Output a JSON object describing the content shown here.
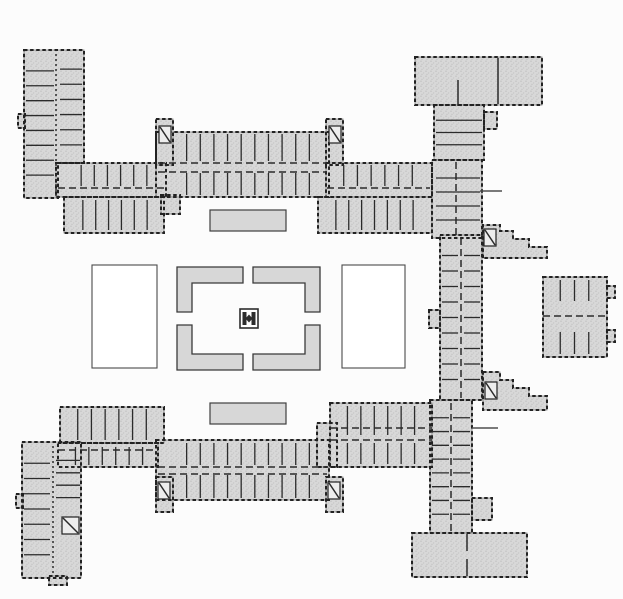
{
  "figure": {
    "type": "architectural-floor-plan",
    "description": "ground floor plan of a courtyard building complex"
  },
  "palette": {
    "background": "#fcfcfc",
    "poche_fill": "#d8d8d8",
    "stipple_dot": "#bdbdbd",
    "wall_dark": "#222222",
    "wall_medium": "#2b2b2b",
    "outline_light": "#7a7a7a",
    "courtyard_white": "#ffffff"
  },
  "plan": {
    "blocks": [
      {
        "name": "northwest-pavilion",
        "d": "M24,50 H84 V163 H58 V198 H24 Z"
      },
      {
        "name": "northwest-pavilion-west-bump",
        "x": 18,
        "y": 114,
        "w": 7,
        "h": 14
      },
      {
        "name": "northwest-link-band",
        "x": 56,
        "y": 163,
        "w": 110,
        "h": 34
      },
      {
        "name": "northwest-south-cells",
        "x": 64,
        "y": 197,
        "w": 100,
        "h": 36
      },
      {
        "name": "north-wing-south-stub",
        "x": 161,
        "y": 195,
        "w": 19,
        "h": 19
      },
      {
        "name": "north-wing-main",
        "x": 156,
        "y": 132,
        "w": 173,
        "h": 65
      },
      {
        "name": "north-wing-tower-west",
        "x": 156,
        "y": 119,
        "w": 17,
        "h": 46
      },
      {
        "name": "north-wing-tower-east",
        "x": 326,
        "y": 119,
        "w": 17,
        "h": 46
      },
      {
        "name": "north-wing-east-band",
        "x": 326,
        "y": 163,
        "w": 106,
        "h": 34
      },
      {
        "name": "north-wing-east-south-cells",
        "x": 318,
        "y": 197,
        "w": 114,
        "h": 36
      },
      {
        "name": "northeast-building",
        "x": 415,
        "y": 57,
        "w": 127,
        "h": 48
      },
      {
        "name": "northeast-link",
        "x": 434,
        "y": 105,
        "w": 50,
        "h": 55
      },
      {
        "name": "northeast-link-side-room",
        "x": 484,
        "y": 112,
        "w": 13,
        "h": 17
      },
      {
        "name": "east-wing-north",
        "x": 432,
        "y": 160,
        "w": 50,
        "h": 78
      },
      {
        "name": "east-wing-middle",
        "x": 440,
        "y": 235,
        "w": 42,
        "h": 165
      },
      {
        "name": "east-wing-west-bay",
        "x": 429,
        "y": 310,
        "w": 11,
        "h": 18
      },
      {
        "name": "east-court-north-steps",
        "d": "M483,258 V225 H500 V231 H513 V239 H529 V247 H547 V258 Z"
      },
      {
        "name": "east-court-south-steps",
        "d": "M483,372 H500 V380 H513 V388 H529 V396 H547 V410 H483 Z"
      },
      {
        "name": "east-pavilion",
        "x": 543,
        "y": 277,
        "w": 64,
        "h": 80
      },
      {
        "name": "east-pavilion-bump-north",
        "x": 607,
        "y": 286,
        "w": 8,
        "h": 12
      },
      {
        "name": "east-pavilion-bump-south",
        "x": 607,
        "y": 330,
        "w": 8,
        "h": 12
      },
      {
        "name": "east-wing-south",
        "x": 430,
        "y": 400,
        "w": 42,
        "h": 133
      },
      {
        "name": "east-wing-south-bump",
        "x": 472,
        "y": 498,
        "w": 20,
        "h": 22
      },
      {
        "name": "south-hall",
        "x": 412,
        "y": 533,
        "w": 115,
        "h": 44
      },
      {
        "name": "south-wing-main",
        "x": 156,
        "y": 440,
        "w": 173,
        "h": 60
      },
      {
        "name": "south-wing-tower-west",
        "x": 156,
        "y": 477,
        "w": 17,
        "h": 35
      },
      {
        "name": "south-wing-tower-east",
        "x": 326,
        "y": 477,
        "w": 17,
        "h": 35
      },
      {
        "name": "southwest-link-band",
        "x": 58,
        "y": 443,
        "w": 100,
        "h": 24
      },
      {
        "name": "southwest-north-cells",
        "x": 60,
        "y": 407,
        "w": 104,
        "h": 36
      },
      {
        "name": "south-wing-east-step",
        "x": 317,
        "y": 423,
        "w": 20,
        "h": 44
      },
      {
        "name": "south-wing-east-segment",
        "x": 330,
        "y": 403,
        "w": 102,
        "h": 64
      },
      {
        "name": "southwest-pavilion",
        "x": 22,
        "y": 442,
        "w": 59,
        "h": 136
      },
      {
        "name": "southwest-pavilion-west-bump",
        "x": 16,
        "y": 494,
        "w": 7,
        "h": 14
      },
      {
        "name": "southwest-pavilion-south-bump",
        "x": 49,
        "y": 576,
        "w": 18,
        "h": 9
      }
    ],
    "courtyards": [
      {
        "name": "west-parterre-court",
        "x": 92,
        "y": 265,
        "w": 65,
        "h": 103
      },
      {
        "name": "east-parterre-court",
        "x": 342,
        "y": 265,
        "w": 63,
        "h": 103
      }
    ],
    "beds": [
      {
        "name": "north-garden-bed",
        "x": 210,
        "y": 210,
        "w": 76,
        "h": 21
      },
      {
        "name": "south-garden-bed",
        "x": 210,
        "y": 403,
        "w": 76,
        "h": 21
      }
    ],
    "parterre": [
      {
        "name": "parterre-hedge-northwest",
        "d": "M177,267 H243 V283 H192 V312 H177 Z"
      },
      {
        "name": "parterre-hedge-northeast",
        "d": "M253,267 H320 V312 H305 V283 H253 Z"
      },
      {
        "name": "parterre-hedge-southwest",
        "d": "M177,325 H192 V354 H243 V370 H177 Z"
      },
      {
        "name": "parterre-hedge-southeast",
        "d": "M305,325 H320 V370 H253 V354 H305 Z"
      }
    ],
    "ornament": {
      "name": "central-fountain-ornament",
      "x": 240,
      "y": 309,
      "w": 18,
      "h": 19
    },
    "cells": [
      {
        "name": "north-wing-upper-cells",
        "x": 173,
        "y": 134,
        "w": 150,
        "h": 27,
        "n": 10,
        "dir": "v"
      },
      {
        "name": "north-wing-lower-cells",
        "x": 173,
        "y": 173,
        "w": 150,
        "h": 22,
        "n": 10,
        "dir": "v"
      },
      {
        "name": "northwest-band-cells",
        "x": 68,
        "y": 165,
        "w": 92,
        "h": 21,
        "n": 6,
        "dir": "v"
      },
      {
        "name": "northwest-south-cell-walls",
        "x": 70,
        "y": 200,
        "w": 90,
        "h": 30,
        "n": 6,
        "dir": "v"
      },
      {
        "name": "north-east-band-cells",
        "x": 330,
        "y": 165,
        "w": 96,
        "h": 21,
        "n": 6,
        "dir": "v"
      },
      {
        "name": "north-east-south-cell-walls",
        "x": 323,
        "y": 200,
        "w": 103,
        "h": 30,
        "n": 7,
        "dir": "v"
      },
      {
        "name": "south-wing-upper-cells",
        "x": 173,
        "y": 443,
        "w": 150,
        "h": 22,
        "n": 10,
        "dir": "v"
      },
      {
        "name": "south-wing-lower-cells",
        "x": 173,
        "y": 475,
        "w": 150,
        "h": 23,
        "n": 10,
        "dir": "v"
      },
      {
        "name": "southwest-band-cells",
        "x": 62,
        "y": 447,
        "w": 94,
        "h": 18,
        "n": 6,
        "dir": "v"
      },
      {
        "name": "southwest-north-cell-walls",
        "x": 64,
        "y": 409,
        "w": 96,
        "h": 31,
        "n": 6,
        "dir": "v"
      },
      {
        "name": "south-east-band-cells",
        "x": 334,
        "y": 443,
        "w": 94,
        "h": 21,
        "n": 6,
        "dir": "v"
      },
      {
        "name": "south-east-north-cell-walls",
        "x": 334,
        "y": 406,
        "w": 94,
        "h": 29,
        "n": 6,
        "dir": "v"
      },
      {
        "name": "east-wing-north-cells",
        "x": 436,
        "y": 164,
        "w": 44,
        "h": 70,
        "n": 4,
        "dir": "h"
      },
      {
        "name": "northeast-link-cells",
        "x": 436,
        "y": 108,
        "w": 46,
        "h": 49,
        "n": 3,
        "dir": "h"
      },
      {
        "name": "east-wing-mid-west-cells",
        "x": 442,
        "y": 240,
        "w": 16,
        "h": 155,
        "n": 9,
        "dir": "h"
      },
      {
        "name": "east-wing-mid-east-cells",
        "x": 464,
        "y": 240,
        "w": 16,
        "h": 155,
        "n": 9,
        "dir": "h"
      },
      {
        "name": "east-wing-south-west-cells",
        "x": 432,
        "y": 404,
        "w": 17,
        "h": 124,
        "n": 8,
        "dir": "h"
      },
      {
        "name": "east-wing-south-east-cells",
        "x": 453,
        "y": 404,
        "w": 17,
        "h": 124,
        "n": 8,
        "dir": "h"
      },
      {
        "name": "east-pavilion-north-cells",
        "x": 546,
        "y": 280,
        "w": 57,
        "h": 21,
        "n": 3,
        "dir": "v"
      },
      {
        "name": "east-pavilion-south-cells",
        "x": 546,
        "y": 332,
        "w": 57,
        "h": 22,
        "n": 3,
        "dir": "v"
      },
      {
        "name": "northwest-pavilion-west-cells",
        "x": 26,
        "y": 56,
        "w": 28,
        "h": 134,
        "n": 8,
        "dir": "h"
      },
      {
        "name": "northwest-pavilion-east-cells",
        "x": 60,
        "y": 54,
        "w": 22,
        "h": 106,
        "n": 6,
        "dir": "h"
      },
      {
        "name": "southwest-pavilion-west-cells",
        "x": 24,
        "y": 448,
        "w": 26,
        "h": 122,
        "n": 7,
        "dir": "h"
      },
      {
        "name": "southwest-pavilion-east-cells",
        "x": 56,
        "y": 448,
        "w": 24,
        "h": 62,
        "n": 4,
        "dir": "h"
      }
    ],
    "inner_walls": [
      {
        "name": "north-corridor-north-wall",
        "x1": 158,
        "y1": 163,
        "x2": 327,
        "y2": 163,
        "dash": "7 4"
      },
      {
        "name": "north-corridor-south-wall",
        "x1": 158,
        "y1": 172,
        "x2": 327,
        "y2": 172,
        "dash": "7 4"
      },
      {
        "name": "northwest-band-corridor",
        "x1": 58,
        "y1": 188,
        "x2": 166,
        "y2": 188,
        "dash": "7 4"
      },
      {
        "name": "north-east-band-corridor",
        "x1": 327,
        "y1": 188,
        "x2": 430,
        "y2": 188,
        "dash": "7 4"
      },
      {
        "name": "south-corridor-north-wall",
        "x1": 158,
        "y1": 467,
        "x2": 327,
        "y2": 467,
        "dash": "7 4"
      },
      {
        "name": "south-corridor-south-wall",
        "x1": 158,
        "y1": 474,
        "x2": 327,
        "y2": 474,
        "dash": "7 4"
      },
      {
        "name": "southwest-band-corridor",
        "x1": 58,
        "y1": 450,
        "x2": 158,
        "y2": 450,
        "dash": "7 4"
      },
      {
        "name": "south-east-segment-corridor",
        "x1": 330,
        "y1": 440,
        "x2": 432,
        "y2": 440,
        "dash": "7 4"
      },
      {
        "name": "south-east-segment-north-wall",
        "x1": 330,
        "y1": 428,
        "x2": 432,
        "y2": 428,
        "dash": "7 4"
      },
      {
        "name": "east-wing-mid-corridor",
        "x1": 461,
        "y1": 238,
        "x2": 461,
        "y2": 398,
        "dash": "7 4"
      },
      {
        "name": "east-wing-south-corridor",
        "x1": 451,
        "y1": 403,
        "x2": 451,
        "y2": 531,
        "dash": "7 4"
      },
      {
        "name": "east-wing-north-corridor",
        "x1": 456,
        "y1": 162,
        "x2": 456,
        "y2": 236,
        "dash": "7 4"
      },
      {
        "name": "east-pavilion-corridor",
        "x1": 543,
        "y1": 316,
        "x2": 607,
        "y2": 316,
        "dash": "7 4"
      },
      {
        "name": "northeast-building-wall-east",
        "x1": 498,
        "y1": 58,
        "x2": 498,
        "y2": 104
      },
      {
        "name": "northeast-building-wall-west",
        "x1": 458,
        "y1": 80,
        "x2": 458,
        "y2": 104
      },
      {
        "name": "south-hall-divider-upper",
        "x1": 467,
        "y1": 534,
        "x2": 467,
        "y2": 551
      },
      {
        "name": "south-hall-divider-lower",
        "x1": 467,
        "y1": 559,
        "x2": 467,
        "y2": 576
      },
      {
        "name": "northwest-pavilion-corridor",
        "x1": 56,
        "y1": 54,
        "x2": 56,
        "y2": 196,
        "dash": "2 3"
      },
      {
        "name": "southwest-pavilion-corridor",
        "x1": 53,
        "y1": 446,
        "x2": 53,
        "y2": 574,
        "dash": "2 3"
      }
    ],
    "stairs": [
      {
        "name": "stair-north-tower-west",
        "x": 159,
        "y": 126,
        "w": 12,
        "h": 17
      },
      {
        "name": "stair-north-tower-east",
        "x": 329,
        "y": 126,
        "w": 12,
        "h": 17
      },
      {
        "name": "stair-south-tower-west",
        "x": 158,
        "y": 482,
        "w": 12,
        "h": 17
      },
      {
        "name": "stair-south-tower-east",
        "x": 328,
        "y": 482,
        "w": 12,
        "h": 17
      },
      {
        "name": "stair-southwest-pavilion",
        "x": 62,
        "y": 517,
        "w": 17,
        "h": 17
      },
      {
        "name": "stair-northeast-court",
        "x": 484,
        "y": 229,
        "w": 12,
        "h": 17
      },
      {
        "name": "stair-southeast-court",
        "x": 485,
        "y": 382,
        "w": 12,
        "h": 17
      }
    ],
    "garden_walls": [
      {
        "name": "east-terrace-wall-north",
        "x1": 480,
        "y1": 191,
        "x2": 502,
        "y2": 191
      },
      {
        "name": "east-terrace-wall-south",
        "x1": 472,
        "y1": 428,
        "x2": 498,
        "y2": 428
      }
    ]
  }
}
